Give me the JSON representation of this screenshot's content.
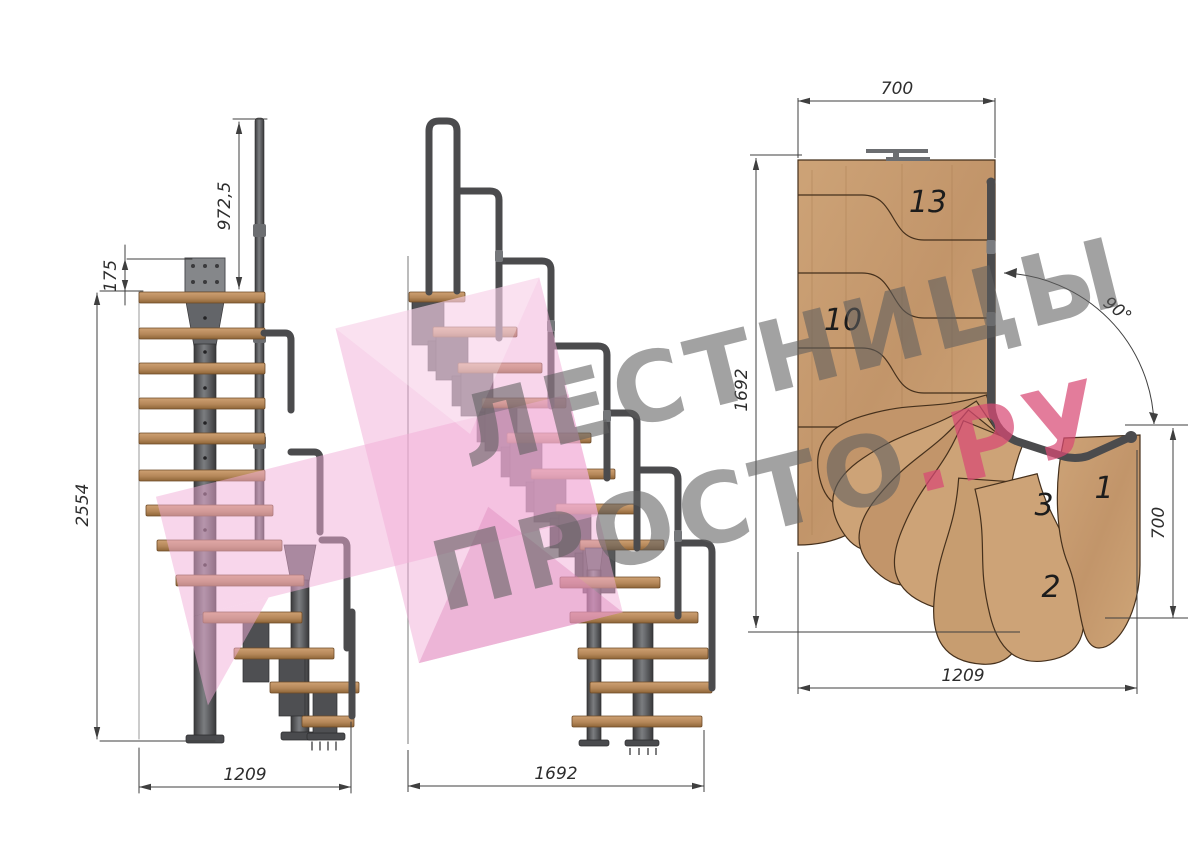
{
  "watermark": {
    "line1": "ЛЕСТНИЦЫ",
    "line2_grey": "ПРОСТО",
    "line2_pink": ".РУ",
    "grey_color": "#5f5f5f",
    "pink_text_color": "#d84a74",
    "logo_pink_color": "#f2aed8"
  },
  "front_view": {
    "dims": {
      "handrail_height": "972,5",
      "top_offset": "175",
      "total_height": "2554",
      "width": "1209"
    }
  },
  "side_view": {
    "dims": {
      "length": "1692"
    }
  },
  "plan_view": {
    "dims": {
      "top_width": "700",
      "depth": "1692",
      "turn_angle": "90°",
      "right_height": "700",
      "bottom_width": "1209"
    },
    "steps": {
      "n13": "13",
      "n10": "10",
      "n3": "3",
      "n1": "1",
      "n2": "2"
    }
  },
  "colors": {
    "wood": "#c79d70",
    "wood_dark": "#a87c50",
    "metal": "#55565a",
    "dim_line": "#3f3f3f"
  }
}
